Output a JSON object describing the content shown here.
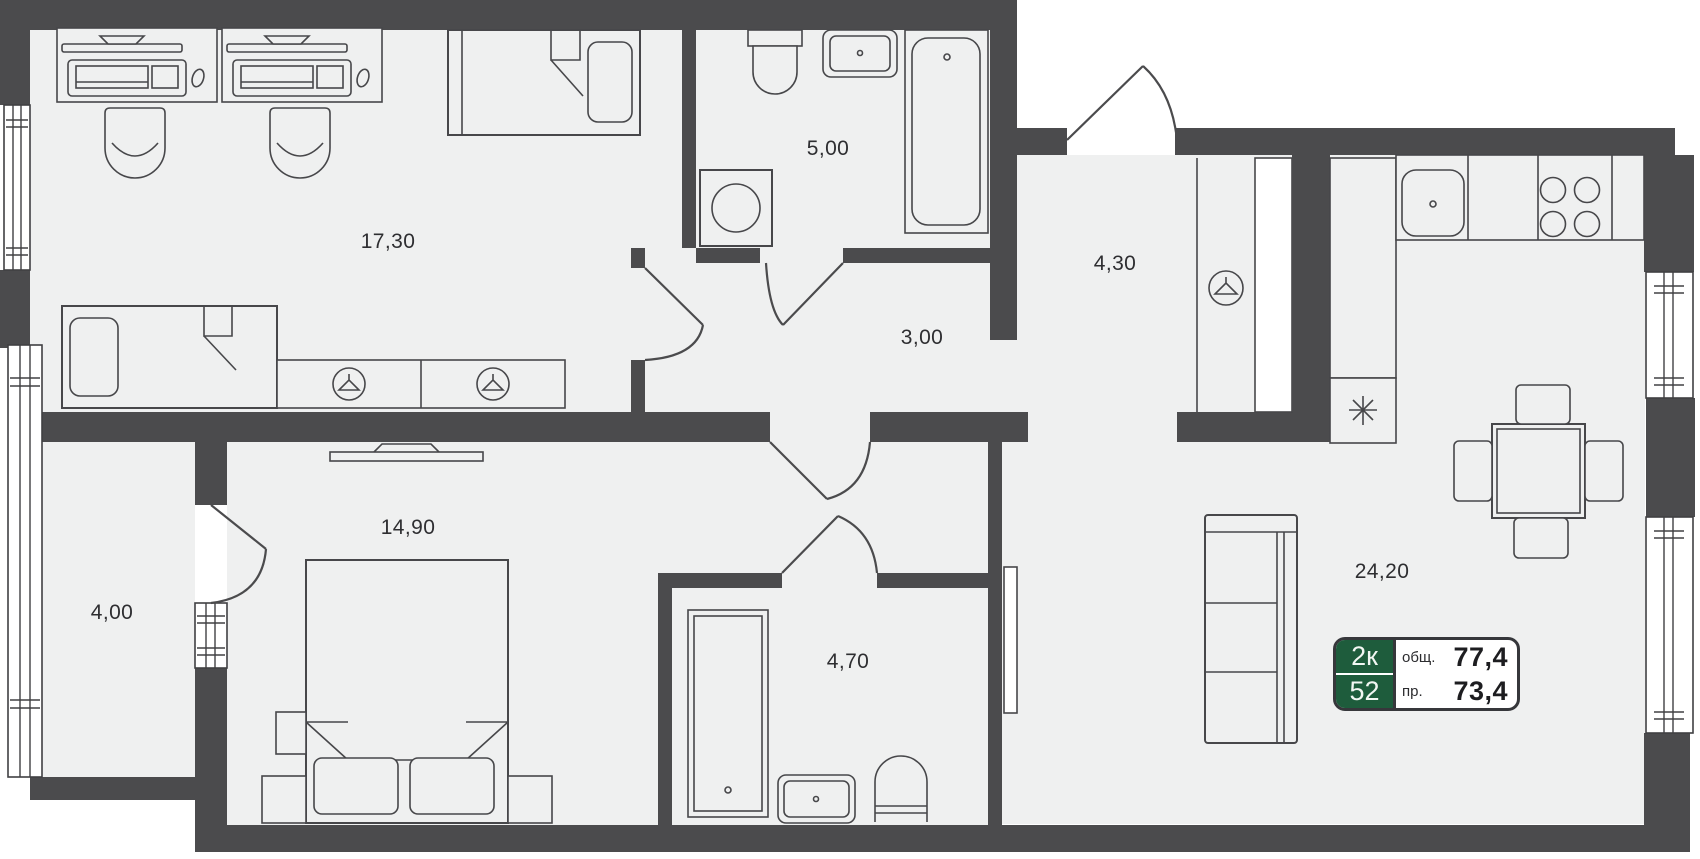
{
  "plan": {
    "rooms": [
      {
        "id": "bedroom-office",
        "area": "17,30"
      },
      {
        "id": "bathroom",
        "area": "5,00"
      },
      {
        "id": "hallway",
        "area": "3,00"
      },
      {
        "id": "entry-hall",
        "area": "4,30"
      },
      {
        "id": "bedroom",
        "area": "14,90"
      },
      {
        "id": "balcony",
        "area": "4,00"
      },
      {
        "id": "shower-room",
        "area": "4,70"
      },
      {
        "id": "kitchen-living-room",
        "area": "24,20"
      }
    ],
    "badge": {
      "rooms_count": "2к",
      "unit_number": "52",
      "total_label": "общ.",
      "total_value": "77,4",
      "living_label": "пр.",
      "living_value": "73,4"
    },
    "icons": {
      "wardrobe-hanger-icon": "clothes-hanger-in-circle",
      "fridge-snowflake-icon": "✳"
    },
    "colors": {
      "wall": "#4b4b4d",
      "floor": "#eff0f0",
      "badge_green": "#1e5c3c",
      "outline": "#47474a"
    }
  }
}
